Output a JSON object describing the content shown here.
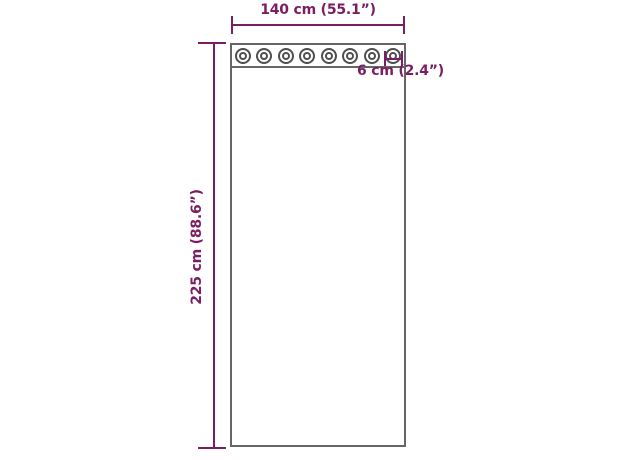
{
  "diagram": {
    "width_label": "140 cm (55.1”)",
    "height_label": "225 cm (88.6”)",
    "grommet_label": "6 cm (2.4”)",
    "grommet_count": 8,
    "colors": {
      "dimension": "#7b1d62",
      "outline": "#666666",
      "grommet": "#4f4f4f",
      "background": "#ffffff"
    }
  }
}
